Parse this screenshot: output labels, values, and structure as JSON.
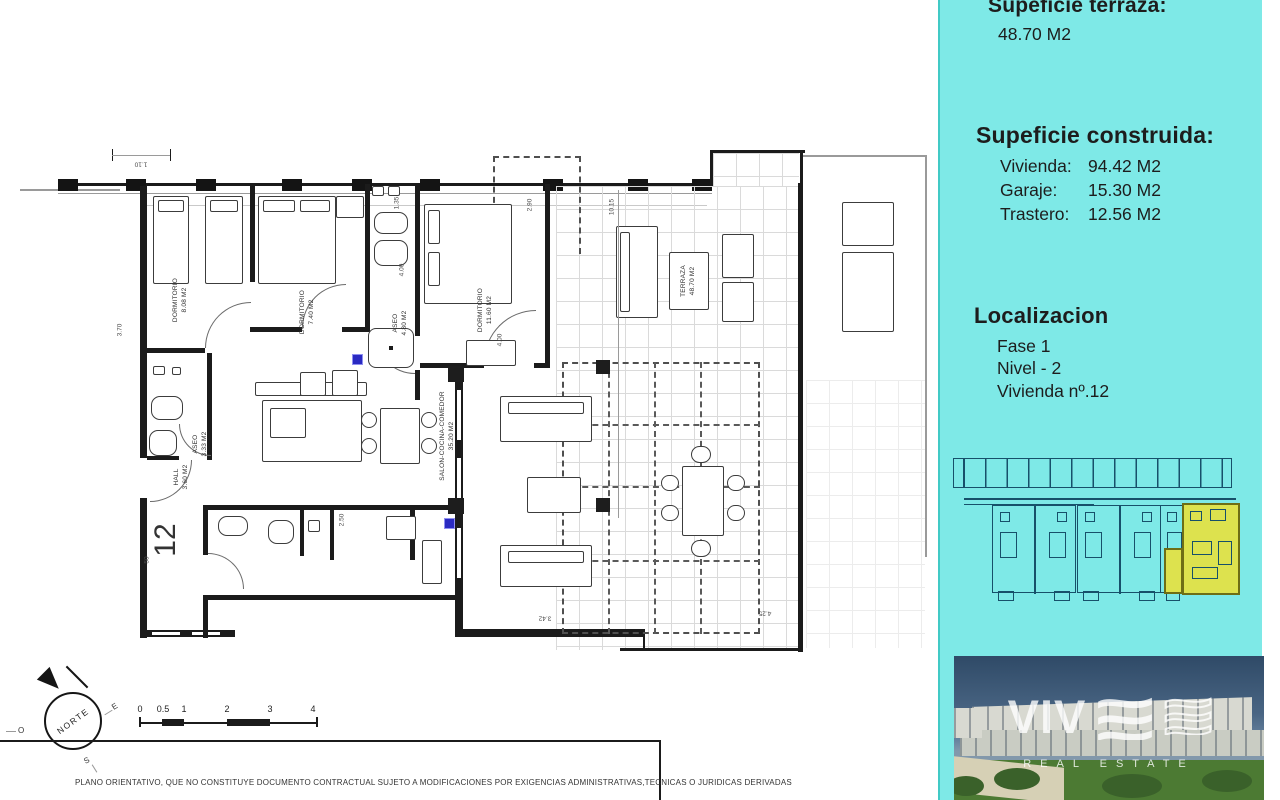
{
  "sidebar": {
    "terrace_heading": "Supeficie terraza:",
    "terrace_value": "48.70 M2",
    "built_heading": "Supeficie construida:",
    "built": [
      {
        "label": "Vivienda:",
        "value": "94.42 M2"
      },
      {
        "label": "Garaje:",
        "value": "15.30 M2"
      },
      {
        "label": "Trastero:",
        "value": "12.56 M2"
      }
    ],
    "location_heading": "Localizacion",
    "location": [
      "Fase 1",
      "Nivel - 2",
      "Vivienda nº.12"
    ]
  },
  "plan": {
    "unit_number": "12",
    "rooms": {
      "dorm1": {
        "name": "DORMITORIO",
        "area": "8.08 M2"
      },
      "dorm2": {
        "name": "DORMITORIO",
        "area": "7.40 M2"
      },
      "master": {
        "name": "DORMITORIO",
        "area": "11.60 M2"
      },
      "aseo1": {
        "name": "ASEO",
        "area": "4.80 M2"
      },
      "aseo2": {
        "name": "ASEO",
        "area": "3.33 M2"
      },
      "hall": {
        "name": "HALL",
        "area": "3.60 M2"
      },
      "salon": {
        "name": "SALON-COCINA-COMEDOR",
        "area": "35.20 M2"
      },
      "terraza": {
        "name": "TERRAZA",
        "area": "48.70 M2"
      }
    },
    "dims": {
      "d110": "1.10",
      "d370": "3.70",
      "d135": "1.35",
      "d400a": "4.00",
      "d290": "2.90",
      "d400b": "4.00",
      "d1015": "10.15",
      "d250": "2.50",
      "d50": "50",
      "d342": "3.42",
      "d425": "4.25"
    },
    "compass": {
      "n": "NORTE",
      "o": "O",
      "e": "E",
      "s": "S"
    },
    "scale_ticks": [
      "0",
      "0.5",
      "1",
      "2",
      "3",
      "4"
    ]
  },
  "branding": {
    "brand": "VIV",
    "tagline": "REAL ESTATE"
  },
  "footer": {
    "disclaimer": "PLANO ORIENTATIVO, QUE NO CONSTITUYE DOCUMENTO CONTRACTUAL SUJETO A MODIFICACIONES POR EXIGENCIAS ADMINISTRATIVAS,TECNICAS O JURIDICAS DERIVADAS"
  },
  "colors": {
    "panel": "#7ee9e7",
    "highlight": "#dde24e",
    "plan_line": "#1b1b1b",
    "minimap_line": "#17506a"
  }
}
